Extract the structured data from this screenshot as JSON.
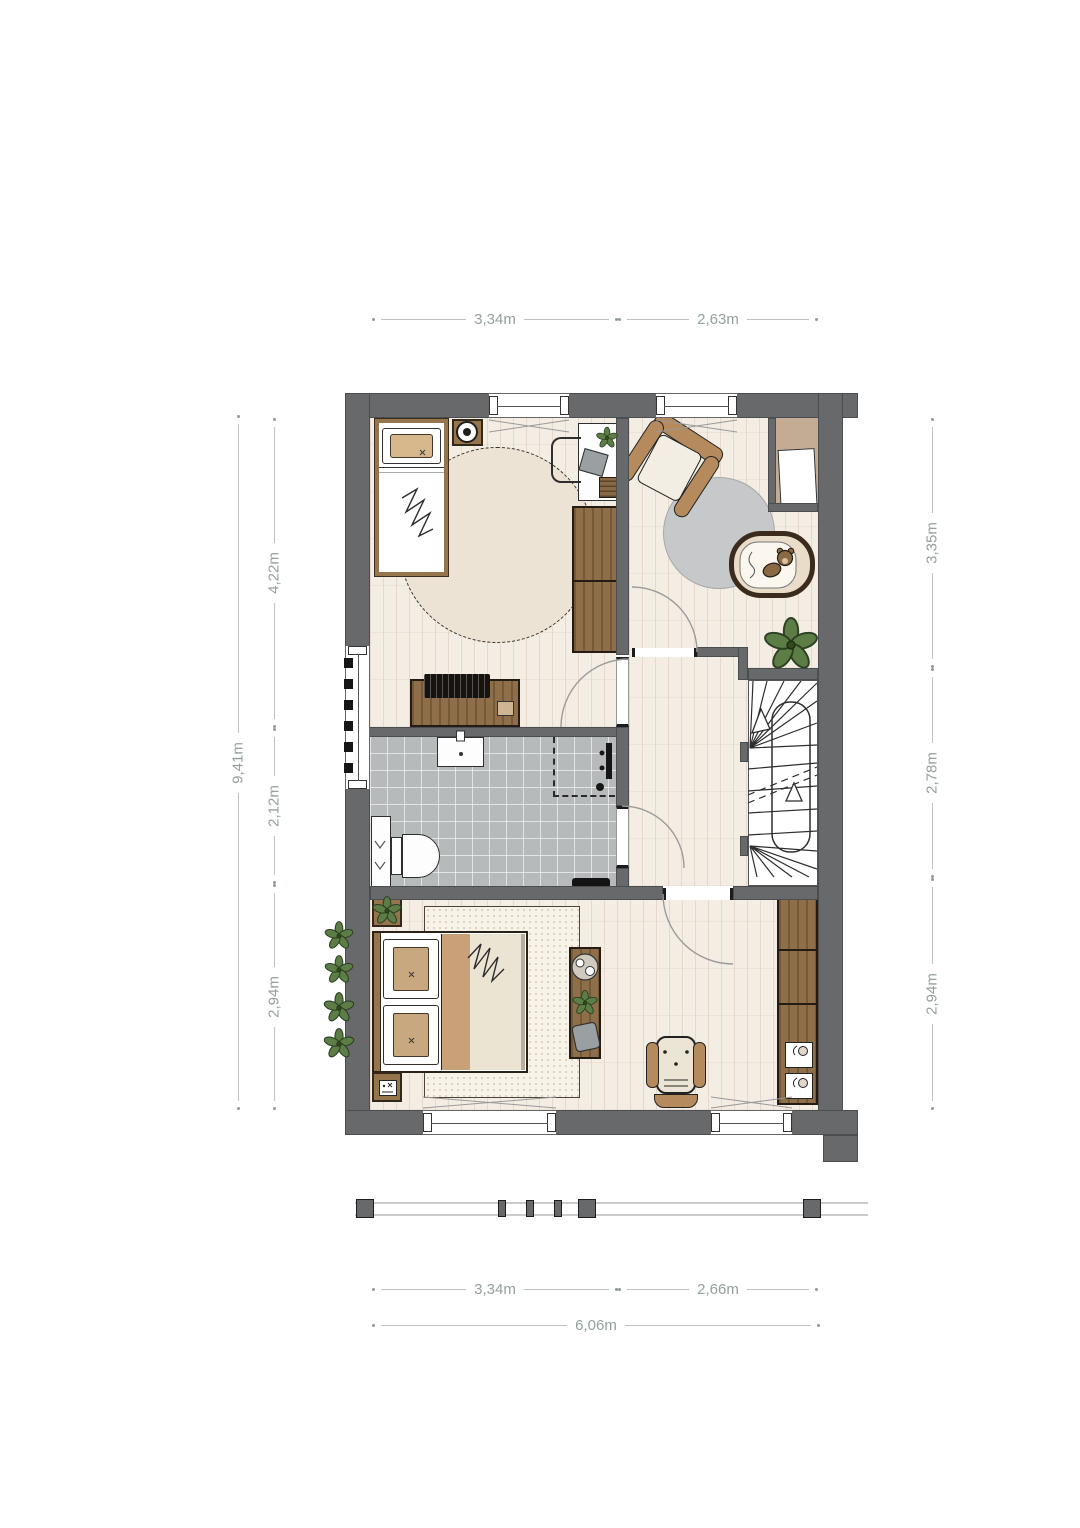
{
  "dimensions": {
    "top": [
      {
        "label": "3,34m"
      },
      {
        "label": "2,63m"
      }
    ],
    "left_overall": {
      "label": "9,41m"
    },
    "left_segments": [
      {
        "label": "4,22m"
      },
      {
        "label": "2,12m"
      },
      {
        "label": "2,94m"
      }
    ],
    "right_segments": [
      {
        "label": "3,35m"
      },
      {
        "label": "2,78m"
      },
      {
        "label": "2,94m"
      }
    ],
    "bottom": [
      {
        "label": "3,34m"
      },
      {
        "label": "2,66m"
      }
    ],
    "bottom_overall": {
      "label": "6,06m"
    }
  },
  "colors": {
    "wall": "#67696b",
    "wood_floor": "#f4ede4",
    "tile_floor": "#b7baba",
    "wood_furniture": "#96744c",
    "fabric_cream": "#ece3d4",
    "fabric_tan": "#c8a87e",
    "plant_green": "#5c7d46",
    "rug_gray": "#c6c8ca",
    "dimension_text": "#93a09c",
    "sketch_line": "#2e2e2e"
  }
}
